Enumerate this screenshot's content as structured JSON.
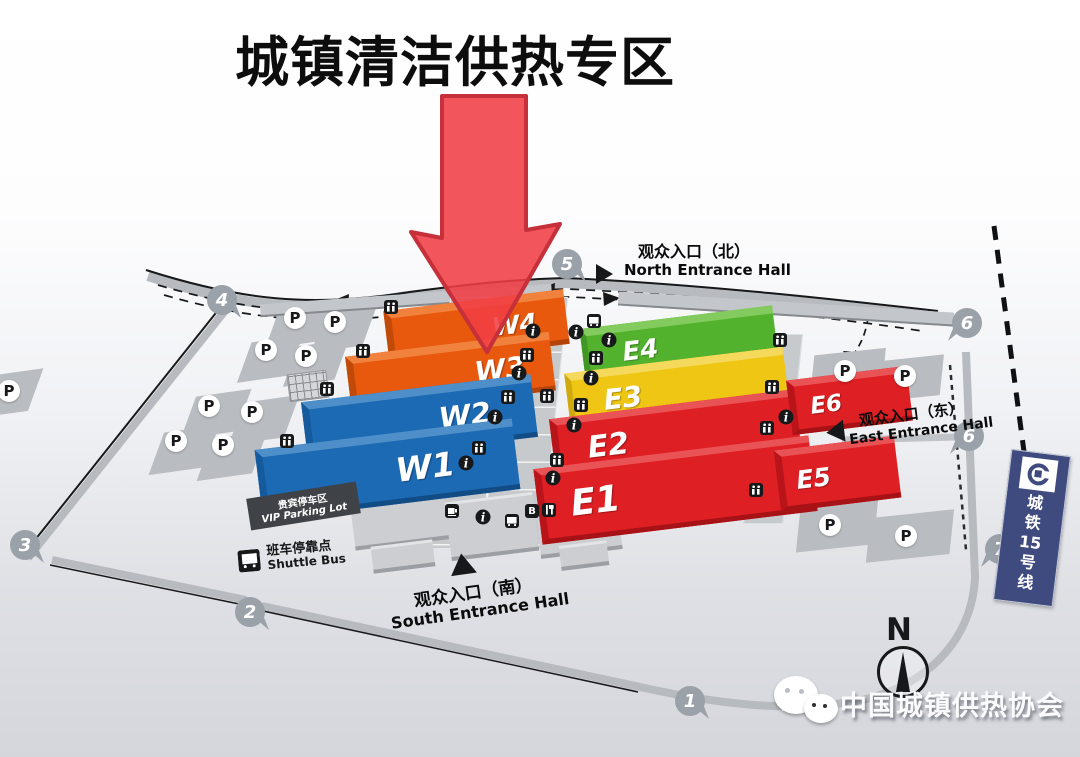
{
  "title": "城镇清洁供热专区",
  "halls": {
    "w1": "W1",
    "w2": "W2",
    "w3": "W3",
    "w4": "W4",
    "e1": "E1",
    "e2": "E2",
    "e3": "E3",
    "e4": "E4",
    "e5": "E5",
    "e6": "E6"
  },
  "entrances": {
    "north_cn": "观众入口（北）",
    "north_en": "North Entrance Hall",
    "east_cn": "观众入口（东）",
    "east_en": "East Entrance Hall",
    "south_cn": "观众入口（南）",
    "south_en": "South Entrance Hall"
  },
  "facilities": {
    "vip_cn": "贵宾停车区",
    "vip_en": "VIP Parking Lot",
    "shuttle_cn": "班车停靠点",
    "shuttle_en": "Shuttle Bus",
    "parking_letter": "P"
  },
  "gates": [
    "1",
    "2",
    "3",
    "4",
    "5",
    "6",
    "6",
    "7"
  ],
  "metro": {
    "label": "城铁15号线",
    "chars": [
      "城",
      "铁",
      "15",
      "号",
      "线"
    ]
  },
  "compass_label": "N",
  "watermark_text": "中国城镇供热协会",
  "icon_legend": {
    "info-icon": "black circle with white italic i",
    "restroom-icon": "black rounded square with two person figures",
    "restaurant-icon": "black rounded square with fork and knife",
    "bus-icon": "black rounded square with bus",
    "b-icon": "black rounded square with letter B",
    "cafe-icon": "black rounded square with cup"
  },
  "colors": {
    "hall_orange": "#e8590e",
    "hall_blue": "#1c69b4",
    "hall_red": "#de1f24",
    "hall_green": "#52b22d",
    "hall_yellow": "#eec613",
    "arrow_red": "#ef3e44",
    "metro_blue": "#3f4b7e",
    "road_gray": "#b7babf"
  }
}
